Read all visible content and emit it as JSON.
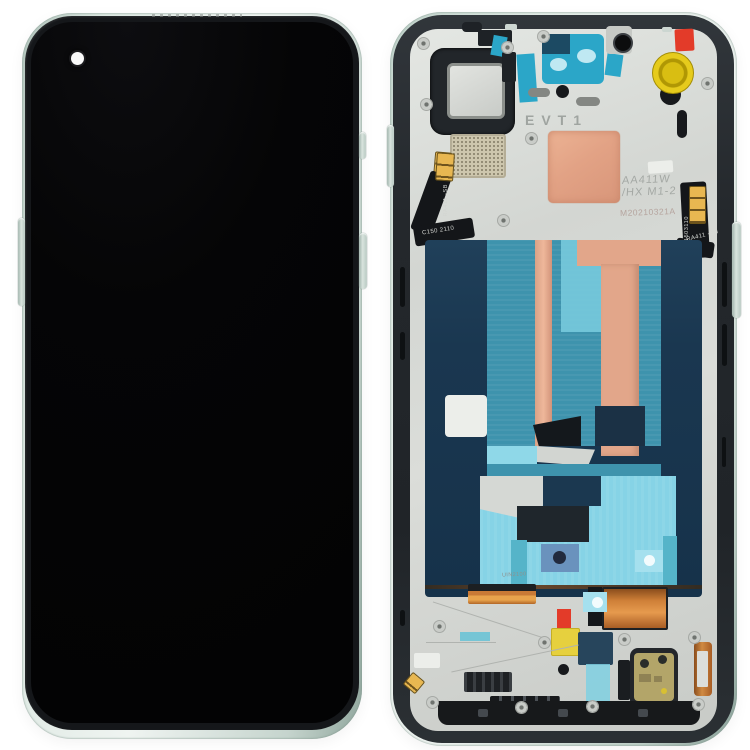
{
  "etched_labels": {
    "build_stage": "EVT1",
    "model_line1": "AA411W",
    "model_line2": "/HX M1-2",
    "date_code": "M20210321A",
    "frame_code": "UIN2100"
  },
  "flex_labels": {
    "left_vertical": "RA411 -SB",
    "left_horizontal": "C150 2110",
    "right_vertical": "C1503110",
    "right_horizontal": "RA411 -SB"
  },
  "colors": {
    "background": "#ffffff",
    "frame_green": "#cfe0d8",
    "midframe_silver": "#d4d7d3",
    "adhesive_teal": "#2ba6c8",
    "panel_navy": "#1a3750",
    "panel_teal": "#3e93ad",
    "panel_cyan": "#86d3e6",
    "copper_film": "#e2a285",
    "copper_coil": "#cf8038",
    "kapton_yellow": "#e6d03e",
    "tape_red": "#e33b29",
    "screen_black": "#050506",
    "gold_contact": "#e8b751"
  }
}
